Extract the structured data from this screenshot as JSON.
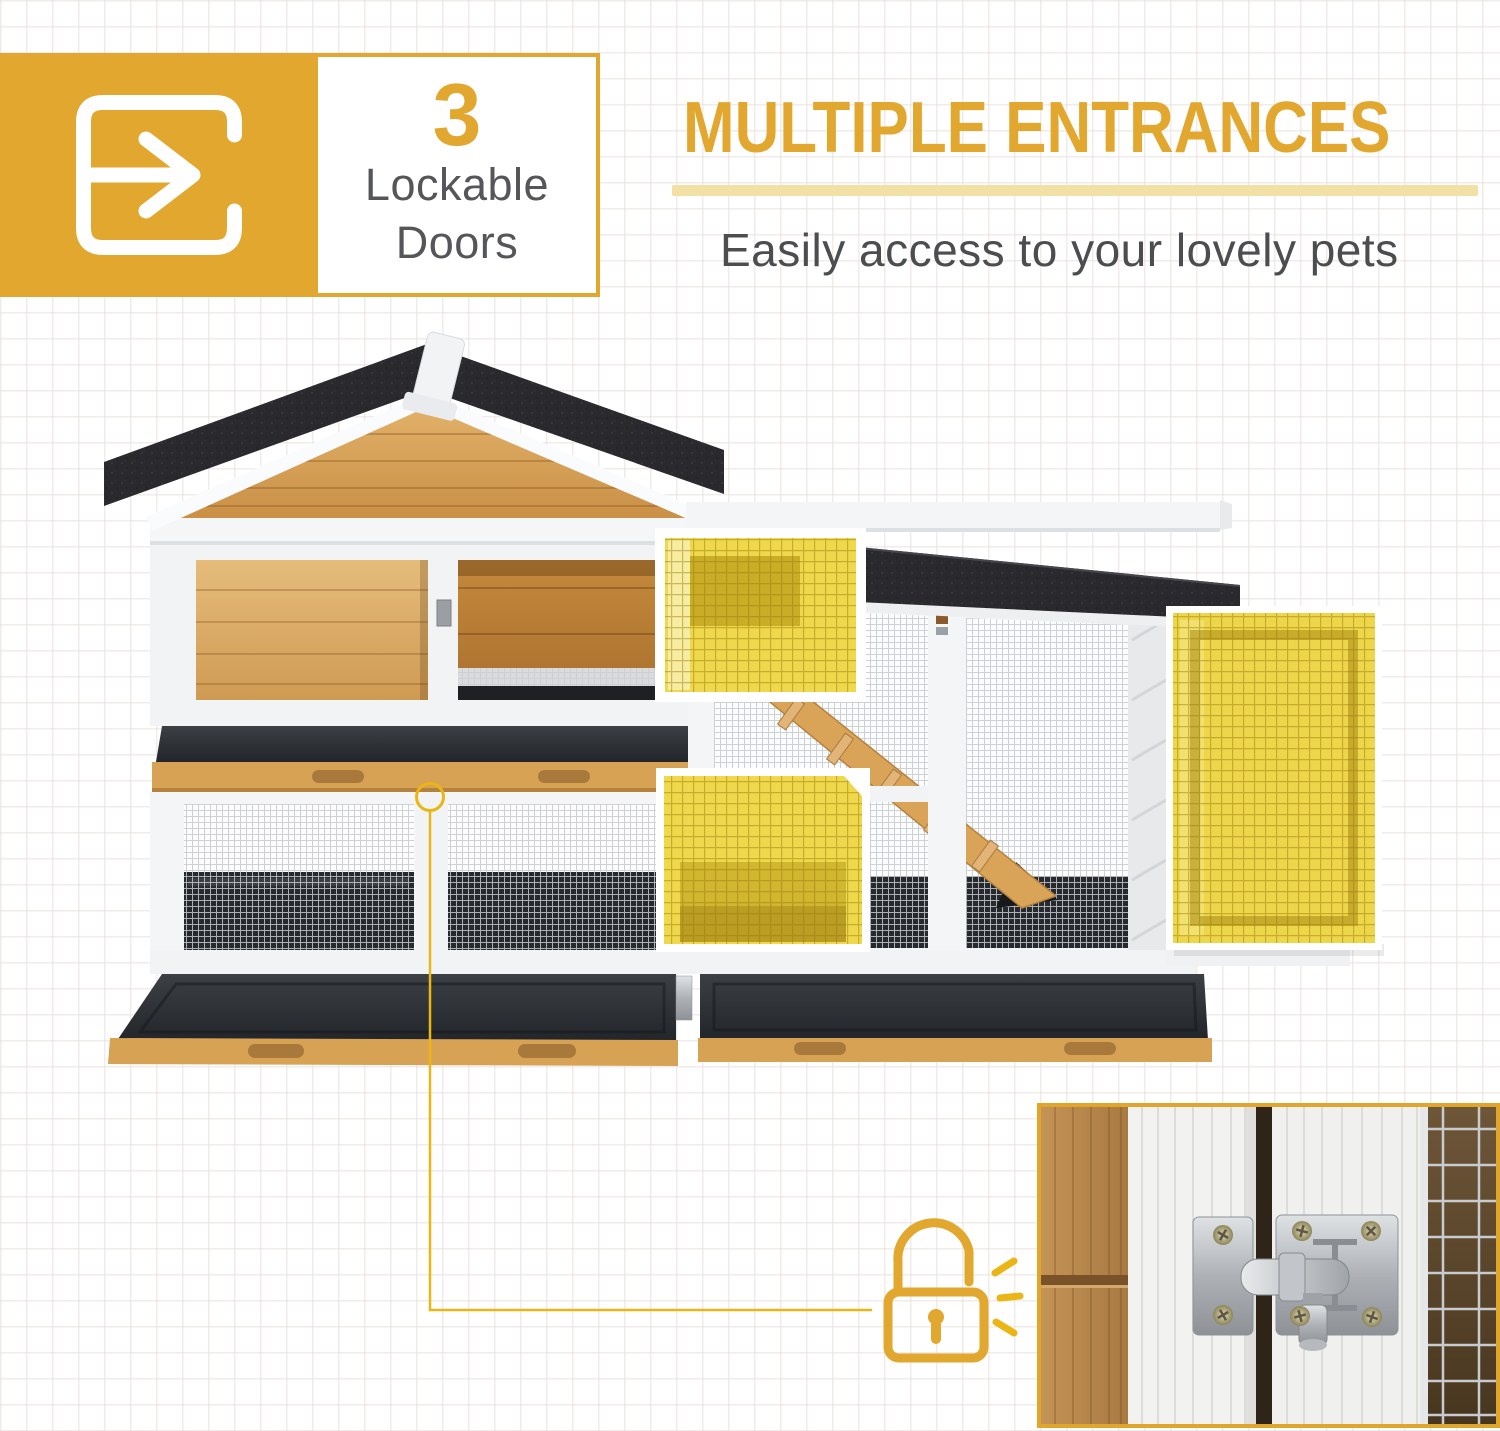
{
  "badge": {
    "count": "3",
    "line1": "Lockable",
    "line2": "Doors",
    "icon": "door-entrance-icon"
  },
  "header": {
    "title": "MULTIPLE ENTRANCES",
    "subtitle": "Easily access to your lovely pets"
  },
  "figure": {
    "subject": "two-story wooden pet hutch with black asphalt roof, wire-mesh run and pull-out trays",
    "highlighted_doors": 3,
    "highlight_color": "#EFD84C",
    "accent_color": "#E2A72E",
    "underline_color": "#F3E0A4",
    "callout_icon": "open-padlock-icon",
    "inset_subject": "metal slide-bolt door latch close-up"
  }
}
